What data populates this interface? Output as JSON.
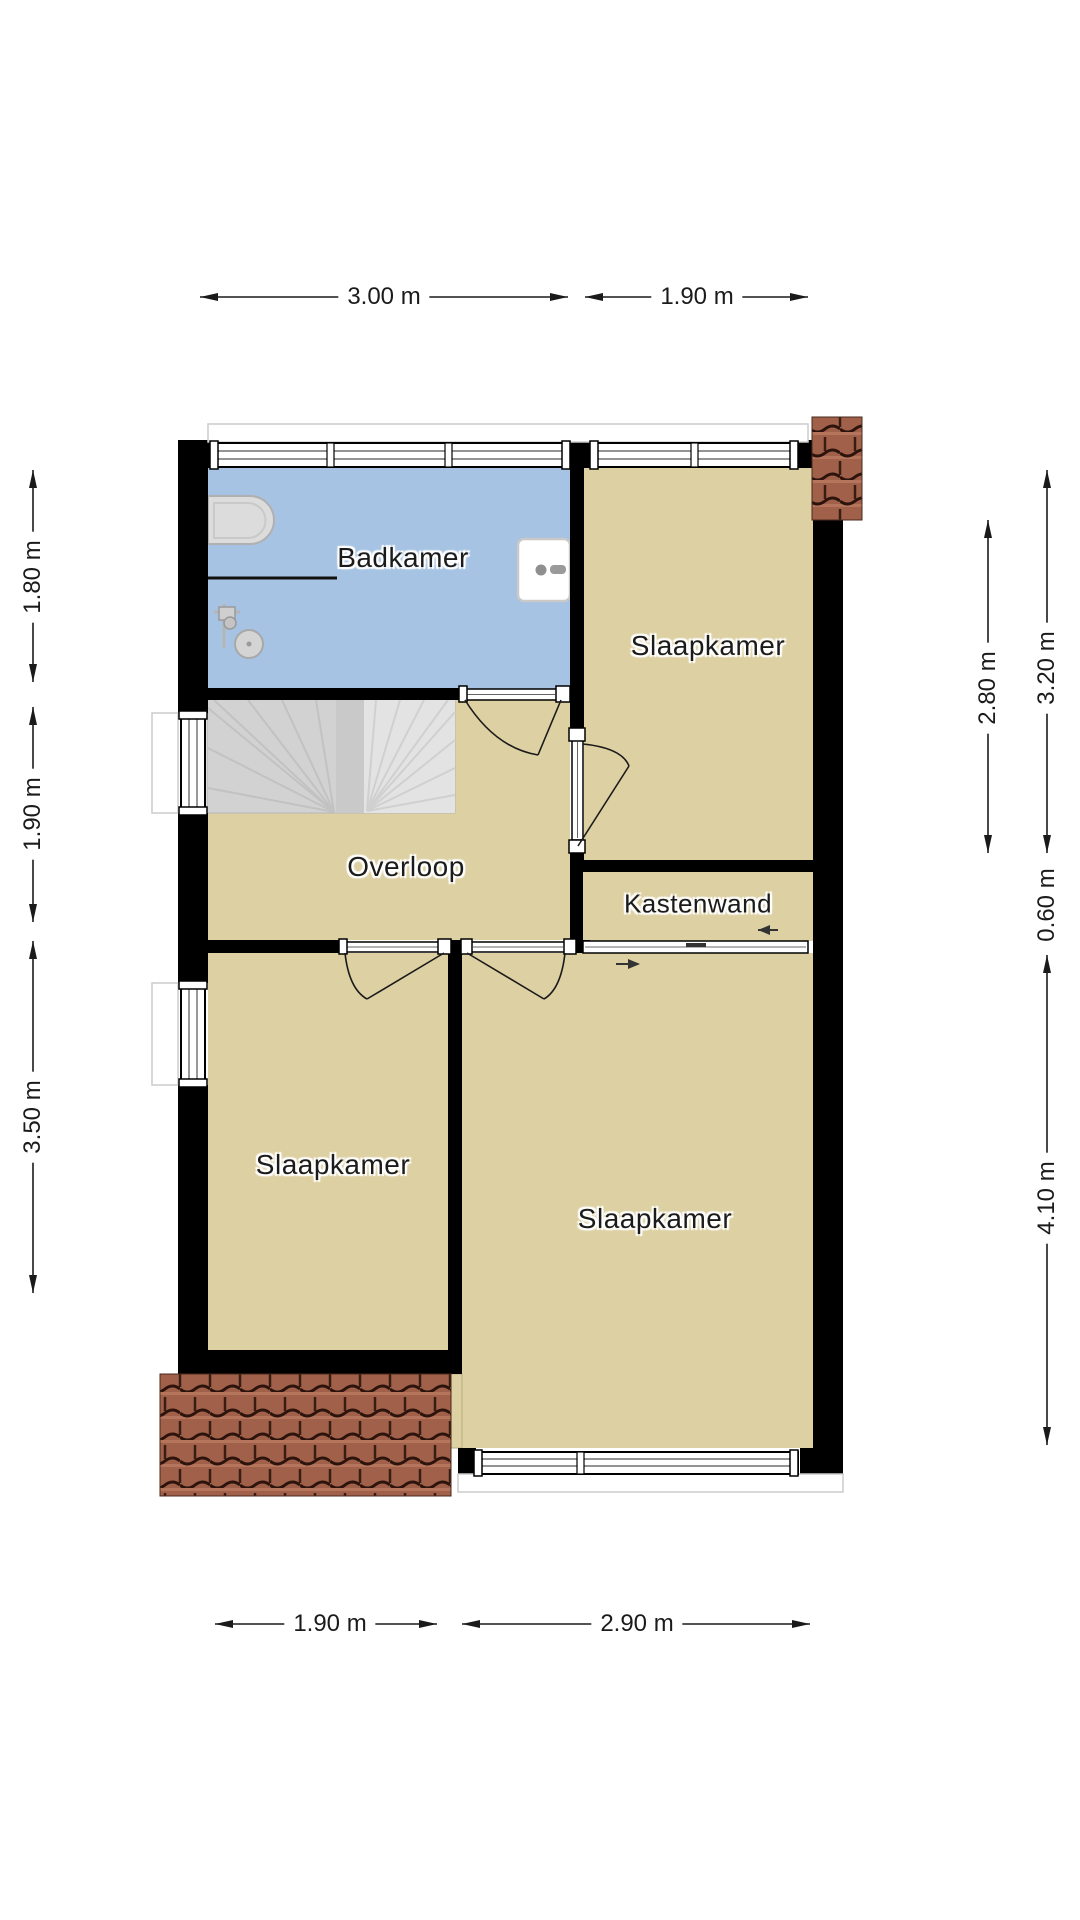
{
  "title": "Floor plan - first floor (verdieping)",
  "rooms": {
    "badkamer": "Badkamer",
    "slaapkamer_tr": "Slaapkamer",
    "overloop": "Overloop",
    "kastenwand": "Kastenwand",
    "slaapkamer_bl": "Slaapkamer",
    "slaapkamer_br": "Slaapkamer"
  },
  "dimensions": {
    "top_left": "3.00 m",
    "top_right": "1.90 m",
    "bottom_left": "1.90 m",
    "bottom_right": "2.90 m",
    "left_1": "1.80 m",
    "left_2": "1.90 m",
    "left_3": "3.50 m",
    "right_inner": "2.80 m",
    "right_outer_1": "3.20 m",
    "right_outer_2": "0.60 m",
    "right_outer_3": "4.10 m"
  },
  "icons": {
    "fixtures": [
      "bathtub-icon",
      "shower-icon",
      "sink-icon"
    ],
    "features": [
      "stairs",
      "roof-tiles",
      "door-swing",
      "sliding-door",
      "window"
    ]
  },
  "colors": {
    "floor": "#ddd0a2",
    "bathroom_floor": "#a6c3e3",
    "wall": "#000000",
    "roof_tile": "#a0604a",
    "stairs": "#d2d2d2",
    "dimension_line": "#1a1a1a"
  }
}
